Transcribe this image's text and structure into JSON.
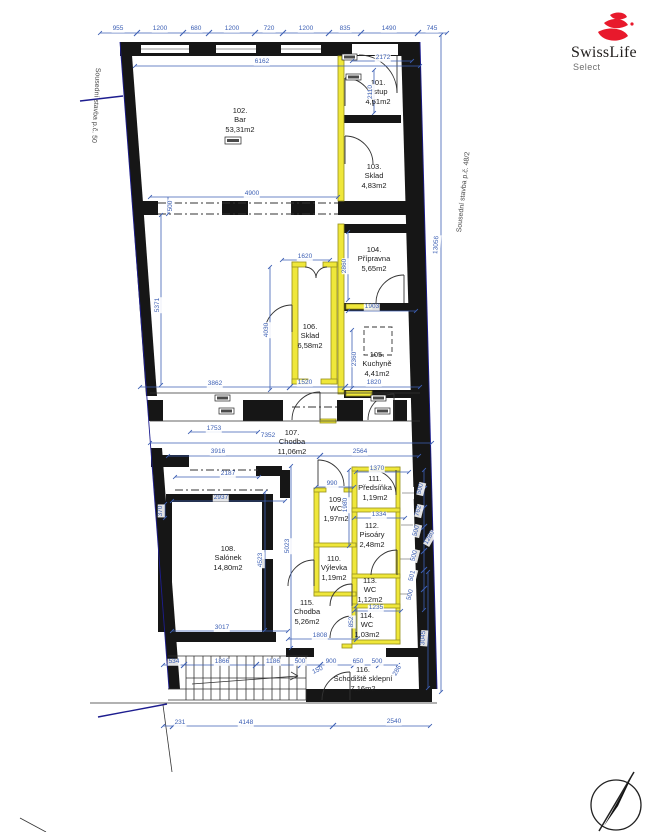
{
  "title": "Floor plan drawing (1.NP) with SwissLife Select logo",
  "logo": {
    "brand": "SwissLife",
    "sub": "Select",
    "accent_color": "#e8192c",
    "text_color": "#23201f"
  },
  "side_labels": {
    "left": "Sousední stavba p.č. 50",
    "right": "Sousední stavba p.č. 48/2"
  },
  "colors": {
    "dimension_blue": "#3c5fb4",
    "wall_black": "#161616",
    "new_wall_yellow": "#efe73a",
    "boundary_navy": "#1d1d8f"
  },
  "rooms": [
    {
      "num": "101.",
      "name": "Vstup",
      "area": "4,51m2",
      "x": 378,
      "y": 92
    },
    {
      "num": "102.",
      "name": "Bar",
      "area": "53,31m2",
      "x": 240,
      "y": 120
    },
    {
      "num": "103.",
      "name": "Sklad",
      "area": "4,83m2",
      "x": 374,
      "y": 176
    },
    {
      "num": "104.",
      "name": "Přípravna",
      "area": "5,65m2",
      "x": 374,
      "y": 259
    },
    {
      "num": "105.",
      "name": "Kuchyně",
      "area": "4,41m2",
      "x": 377,
      "y": 364
    },
    {
      "num": "106.",
      "name": "Sklad",
      "area": "6,58m2",
      "x": 310,
      "y": 336
    },
    {
      "num": "107.",
      "name": "Chodba",
      "area": "11,06m2",
      "x": 292,
      "y": 442
    },
    {
      "num": "108.",
      "name": "Salónek",
      "area": "14,80m2",
      "x": 228,
      "y": 558
    },
    {
      "num": "109.",
      "name": "WC",
      "area": "1,97m2",
      "x": 336,
      "y": 509
    },
    {
      "num": "110.",
      "name": "Výlevka",
      "area": "1,19m2",
      "x": 334,
      "y": 568
    },
    {
      "num": "111.",
      "name": "Předsíňka",
      "area": "1,19m2",
      "x": 375,
      "y": 488
    },
    {
      "num": "112.",
      "name": "Pisoáry",
      "area": "2,48m2",
      "x": 372,
      "y": 535
    },
    {
      "num": "113.",
      "name": "WC",
      "area": "1,12m2",
      "x": 370,
      "y": 590
    },
    {
      "num": "114.",
      "name": "WC",
      "area": "1,03m2",
      "x": 367,
      "y": 625
    },
    {
      "num": "115.",
      "name": "Chodba",
      "area": "5,26m2",
      "x": 307,
      "y": 612
    },
    {
      "num": "116.",
      "name": "Schodiště sklepní",
      "area": "7,16m2",
      "x": 363,
      "y": 679
    }
  ],
  "dims": [
    {
      "t": "955",
      "x": 118,
      "y": 29
    },
    {
      "t": "1200",
      "x": 160,
      "y": 29
    },
    {
      "t": "680",
      "x": 196,
      "y": 29
    },
    {
      "t": "1200",
      "x": 232,
      "y": 29
    },
    {
      "t": "720",
      "x": 269,
      "y": 29
    },
    {
      "t": "1200",
      "x": 306,
      "y": 29
    },
    {
      "t": "835",
      "x": 345,
      "y": 29
    },
    {
      "t": "1490",
      "x": 389,
      "y": 29
    },
    {
      "t": "745",
      "x": 432,
      "y": 29
    },
    {
      "t": "6162",
      "x": 262,
      "y": 62
    },
    {
      "t": "2172",
      "x": 383,
      "y": 58
    },
    {
      "t": "2110",
      "x": 371,
      "y": 92,
      "r": -90
    },
    {
      "t": "4900",
      "x": 252,
      "y": 194
    },
    {
      "t": "500",
      "x": 171,
      "y": 206,
      "r": -90
    },
    {
      "t": "5371",
      "x": 158,
      "y": 305,
      "r": -90
    },
    {
      "t": "1620",
      "x": 305,
      "y": 257
    },
    {
      "t": "2860",
      "x": 345,
      "y": 266,
      "r": -90
    },
    {
      "t": "1903",
      "x": 372,
      "y": 307
    },
    {
      "t": "4030",
      "x": 267,
      "y": 330,
      "r": -90
    },
    {
      "t": "2360",
      "x": 355,
      "y": 359,
      "r": -90
    },
    {
      "t": "3862",
      "x": 215,
      "y": 384
    },
    {
      "t": "1520",
      "x": 305,
      "y": 383
    },
    {
      "t": "1820",
      "x": 374,
      "y": 383
    },
    {
      "t": "1753",
      "x": 214,
      "y": 429
    },
    {
      "t": "7352",
      "x": 268,
      "y": 436
    },
    {
      "t": "13056",
      "x": 437,
      "y": 245,
      "r": -86
    },
    {
      "t": "3916",
      "x": 218,
      "y": 452
    },
    {
      "t": "2564",
      "x": 360,
      "y": 452
    },
    {
      "t": "2187",
      "x": 228,
      "y": 474
    },
    {
      "t": "1370",
      "x": 377,
      "y": 469
    },
    {
      "t": "990",
      "x": 332,
      "y": 484
    },
    {
      "t": "2937",
      "x": 221,
      "y": 498
    },
    {
      "t": "370",
      "x": 161,
      "y": 511,
      "r": -90
    },
    {
      "t": "1980",
      "x": 346,
      "y": 505,
      "r": -90
    },
    {
      "t": "1334",
      "x": 379,
      "y": 515
    },
    {
      "t": "500",
      "x": 421,
      "y": 489,
      "r": -76
    },
    {
      "t": "762",
      "x": 419,
      "y": 511,
      "r": -76
    },
    {
      "t": "500",
      "x": 417,
      "y": 531,
      "r": -76
    },
    {
      "t": "1280",
      "x": 430,
      "y": 538,
      "r": -60
    },
    {
      "t": "500",
      "x": 415,
      "y": 556,
      "r": -76
    },
    {
      "t": "501",
      "x": 413,
      "y": 576,
      "r": -76
    },
    {
      "t": "500",
      "x": 411,
      "y": 595,
      "r": -76
    },
    {
      "t": "4523",
      "x": 261,
      "y": 560,
      "r": -90
    },
    {
      "t": "5023",
      "x": 288,
      "y": 546,
      "r": -90
    },
    {
      "t": "1235",
      "x": 376,
      "y": 608
    },
    {
      "t": "852",
      "x": 352,
      "y": 622,
      "r": -90
    },
    {
      "t": "3017",
      "x": 222,
      "y": 628
    },
    {
      "t": "1808",
      "x": 320,
      "y": 636
    },
    {
      "t": "3045",
      "x": 424,
      "y": 638,
      "r": -86
    },
    {
      "t": "534",
      "x": 174,
      "y": 662
    },
    {
      "t": "1866",
      "x": 222,
      "y": 662
    },
    {
      "t": "1186",
      "x": 273,
      "y": 662
    },
    {
      "t": "500",
      "x": 300,
      "y": 662
    },
    {
      "t": "900",
      "x": 331,
      "y": 662
    },
    {
      "t": "650",
      "x": 358,
      "y": 662
    },
    {
      "t": "500",
      "x": 377,
      "y": 662
    },
    {
      "t": "150",
      "x": 318,
      "y": 671,
      "r": -25
    },
    {
      "t": "286",
      "x": 398,
      "y": 671,
      "r": -60
    },
    {
      "t": "231",
      "x": 180,
      "y": 723
    },
    {
      "t": "4148",
      "x": 246,
      "y": 723
    },
    {
      "t": "2540",
      "x": 394,
      "y": 722
    }
  ]
}
